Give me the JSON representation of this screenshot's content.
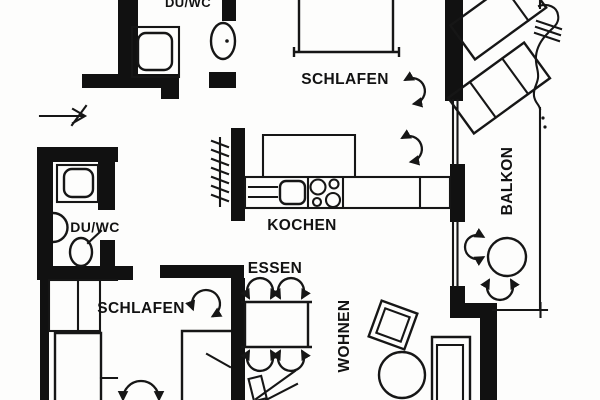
{
  "plan": {
    "colors": {
      "ink": "#161616",
      "wall": "#111111",
      "background": "#fdfdfc"
    },
    "labels": {
      "bathroom_top": "DU/WC",
      "bedroom_top": "SCHLAFEN",
      "kitchen": "KOCHEN",
      "dining": "ESSEN",
      "living": "WOHNEN",
      "bedroom_bottom": "SCHLAFEN",
      "bathroom_bottom": "DU/WC",
      "balcony": "BALKON"
    }
  }
}
